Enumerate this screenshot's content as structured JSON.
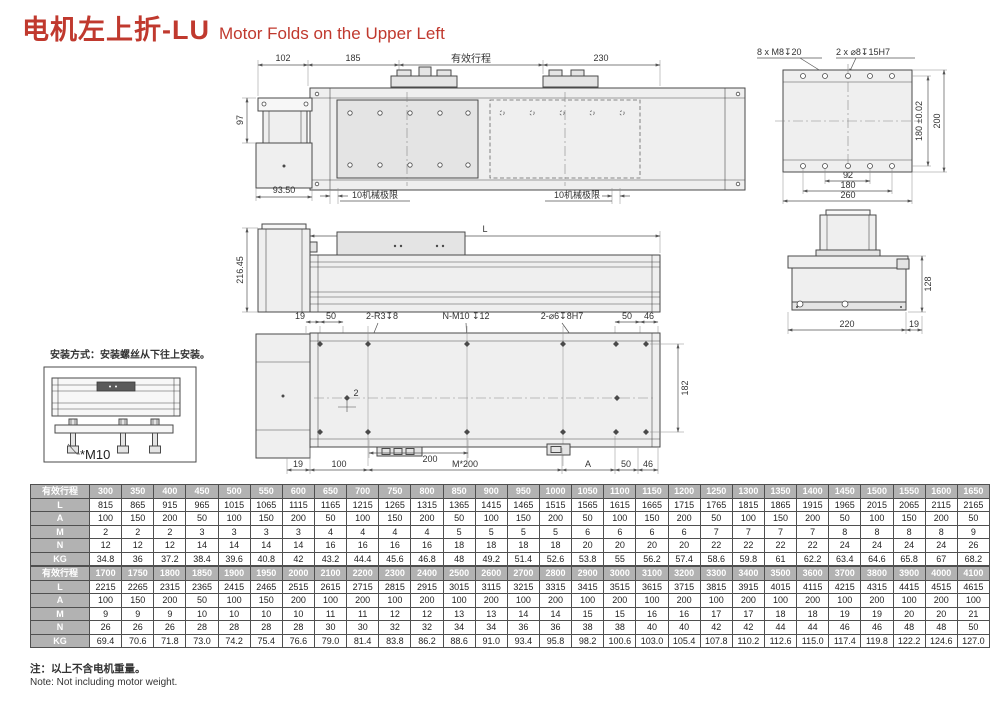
{
  "title": {
    "zh": "电机左上折-LU",
    "en": "Motor Folds on the Upper Left"
  },
  "colors": {
    "accent": "#c0392e",
    "table_header_bg": "#b2b2b2",
    "line": "#4a4a4a"
  },
  "drawing": {
    "top_view": {
      "dim_102": "102",
      "dim_185": "185",
      "dim_stroke": "有效行程",
      "dim_230": "230",
      "dim_97": "97",
      "dim_93_50": "93.50",
      "limit_left": "10机械极限",
      "limit_right": "10机械极限"
    },
    "rear_view": {
      "callout_m8": "8 x M8↧20",
      "callout_dowel": "2 x ⌀8↧15H7",
      "dim_180_tol": "180 ±0.02",
      "dim_200": "200",
      "dim_92": "92",
      "dim_180": "180",
      "dim_260": "260"
    },
    "side_view": {
      "dim_L": "L",
      "dim_216_45": "216.45"
    },
    "side_end_view": {
      "dim_128": "128",
      "dim_220": "220",
      "dim_19": "19"
    },
    "bottom_view": {
      "dim_19_tl": "19",
      "dim_50_tl": "50",
      "callout_r3": "2-R3↧8",
      "callout_nm10": "N-M10 ↧12",
      "callout_d6": "2-⌀6↧8H7",
      "dim_50_tr": "50",
      "dim_46_tr": "46",
      "dim_182": "182",
      "dim_2": "2",
      "dim_19_bl": "19",
      "dim_100": "100",
      "dim_200": "200",
      "dim_m200": "M*200",
      "dim_A": "A",
      "dim_50_br": "50",
      "dim_46_br": "46"
    },
    "install": {
      "text": "安装方式：安装螺丝从下往上安装。",
      "label": "*M10"
    }
  },
  "tables": [
    {
      "rows": [
        {
          "label": "有效行程",
          "header": true,
          "values": [
            "300",
            "350",
            "400",
            "450",
            "500",
            "550",
            "600",
            "650",
            "700",
            "750",
            "800",
            "850",
            "900",
            "950",
            "1000",
            "1050",
            "1100",
            "1150",
            "1200",
            "1250",
            "1300",
            "1350",
            "1400",
            "1450",
            "1500",
            "1550",
            "1600",
            "1650"
          ]
        },
        {
          "label": "L",
          "values": [
            "815",
            "865",
            "915",
            "965",
            "1015",
            "1065",
            "1115",
            "1165",
            "1215",
            "1265",
            "1315",
            "1365",
            "1415",
            "1465",
            "1515",
            "1565",
            "1615",
            "1665",
            "1715",
            "1765",
            "1815",
            "1865",
            "1915",
            "1965",
            "2015",
            "2065",
            "2115",
            "2165"
          ]
        },
        {
          "label": "A",
          "values": [
            "100",
            "150",
            "200",
            "50",
            "100",
            "150",
            "200",
            "50",
            "100",
            "150",
            "200",
            "50",
            "100",
            "150",
            "200",
            "50",
            "100",
            "150",
            "200",
            "50",
            "100",
            "150",
            "200",
            "50",
            "100",
            "150",
            "200",
            "50"
          ]
        },
        {
          "label": "M",
          "values": [
            "2",
            "2",
            "2",
            "3",
            "3",
            "3",
            "3",
            "4",
            "4",
            "4",
            "4",
            "5",
            "5",
            "5",
            "5",
            "6",
            "6",
            "6",
            "6",
            "7",
            "7",
            "7",
            "7",
            "8",
            "8",
            "8",
            "8",
            "9"
          ]
        },
        {
          "label": "N",
          "values": [
            "12",
            "12",
            "12",
            "14",
            "14",
            "14",
            "14",
            "16",
            "16",
            "16",
            "16",
            "18",
            "18",
            "18",
            "18",
            "20",
            "20",
            "20",
            "20",
            "22",
            "22",
            "22",
            "22",
            "24",
            "24",
            "24",
            "24",
            "26"
          ]
        },
        {
          "label": "KG",
          "values": [
            "34.8",
            "36",
            "37.2",
            "38.4",
            "39.6",
            "40.8",
            "42",
            "43.2",
            "44.4",
            "45.6",
            "46.8",
            "48",
            "49.2",
            "51.4",
            "52.6",
            "53.8",
            "55",
            "56.2",
            "57.4",
            "58.6",
            "59.8",
            "61",
            "62.2",
            "63.4",
            "64.6",
            "65.8",
            "67",
            "68.2"
          ]
        }
      ]
    },
    {
      "rows": [
        {
          "label": "有效行程",
          "header": true,
          "values": [
            "1700",
            "1750",
            "1800",
            "1850",
            "1900",
            "1950",
            "2000",
            "2100",
            "2200",
            "2300",
            "2400",
            "2500",
            "2600",
            "2700",
            "2800",
            "2900",
            "3000",
            "3100",
            "3200",
            "3300",
            "3400",
            "3500",
            "3600",
            "3700",
            "3800",
            "3900",
            "4000",
            "4100"
          ]
        },
        {
          "label": "L",
          "values": [
            "2215",
            "2265",
            "2315",
            "2365",
            "2415",
            "2465",
            "2515",
            "2615",
            "2715",
            "2815",
            "2915",
            "3015",
            "3115",
            "3215",
            "3315",
            "3415",
            "3515",
            "3615",
            "3715",
            "3815",
            "3915",
            "4015",
            "4115",
            "4215",
            "4315",
            "4415",
            "4515",
            "4615"
          ]
        },
        {
          "label": "A",
          "values": [
            "100",
            "150",
            "200",
            "50",
            "100",
            "150",
            "200",
            "100",
            "200",
            "100",
            "200",
            "100",
            "200",
            "100",
            "200",
            "100",
            "200",
            "100",
            "200",
            "100",
            "200",
            "100",
            "200",
            "100",
            "200",
            "100",
            "200",
            "100"
          ]
        },
        {
          "label": "M",
          "values": [
            "9",
            "9",
            "9",
            "10",
            "10",
            "10",
            "10",
            "11",
            "11",
            "12",
            "12",
            "13",
            "13",
            "14",
            "14",
            "15",
            "15",
            "16",
            "16",
            "17",
            "17",
            "18",
            "18",
            "19",
            "19",
            "20",
            "20",
            "21"
          ]
        },
        {
          "label": "N",
          "values": [
            "26",
            "26",
            "26",
            "28",
            "28",
            "28",
            "28",
            "30",
            "30",
            "32",
            "32",
            "34",
            "34",
            "36",
            "36",
            "38",
            "38",
            "40",
            "40",
            "42",
            "42",
            "44",
            "44",
            "46",
            "46",
            "48",
            "48",
            "50"
          ]
        },
        {
          "label": "KG",
          "values": [
            "69.4",
            "70.6",
            "71.8",
            "73.0",
            "74.2",
            "75.4",
            "76.6",
            "79.0",
            "81.4",
            "83.8",
            "86.2",
            "88.6",
            "91.0",
            "93.4",
            "95.8",
            "98.2",
            "100.6",
            "103.0",
            "105.4",
            "107.8",
            "110.2",
            "112.6",
            "115.0",
            "117.4",
            "119.8",
            "122.2",
            "124.6",
            "127.0"
          ]
        }
      ]
    }
  ],
  "footnote": {
    "zh": "注：以上不含电机重量。",
    "en": "Note: Not including motor weight."
  }
}
